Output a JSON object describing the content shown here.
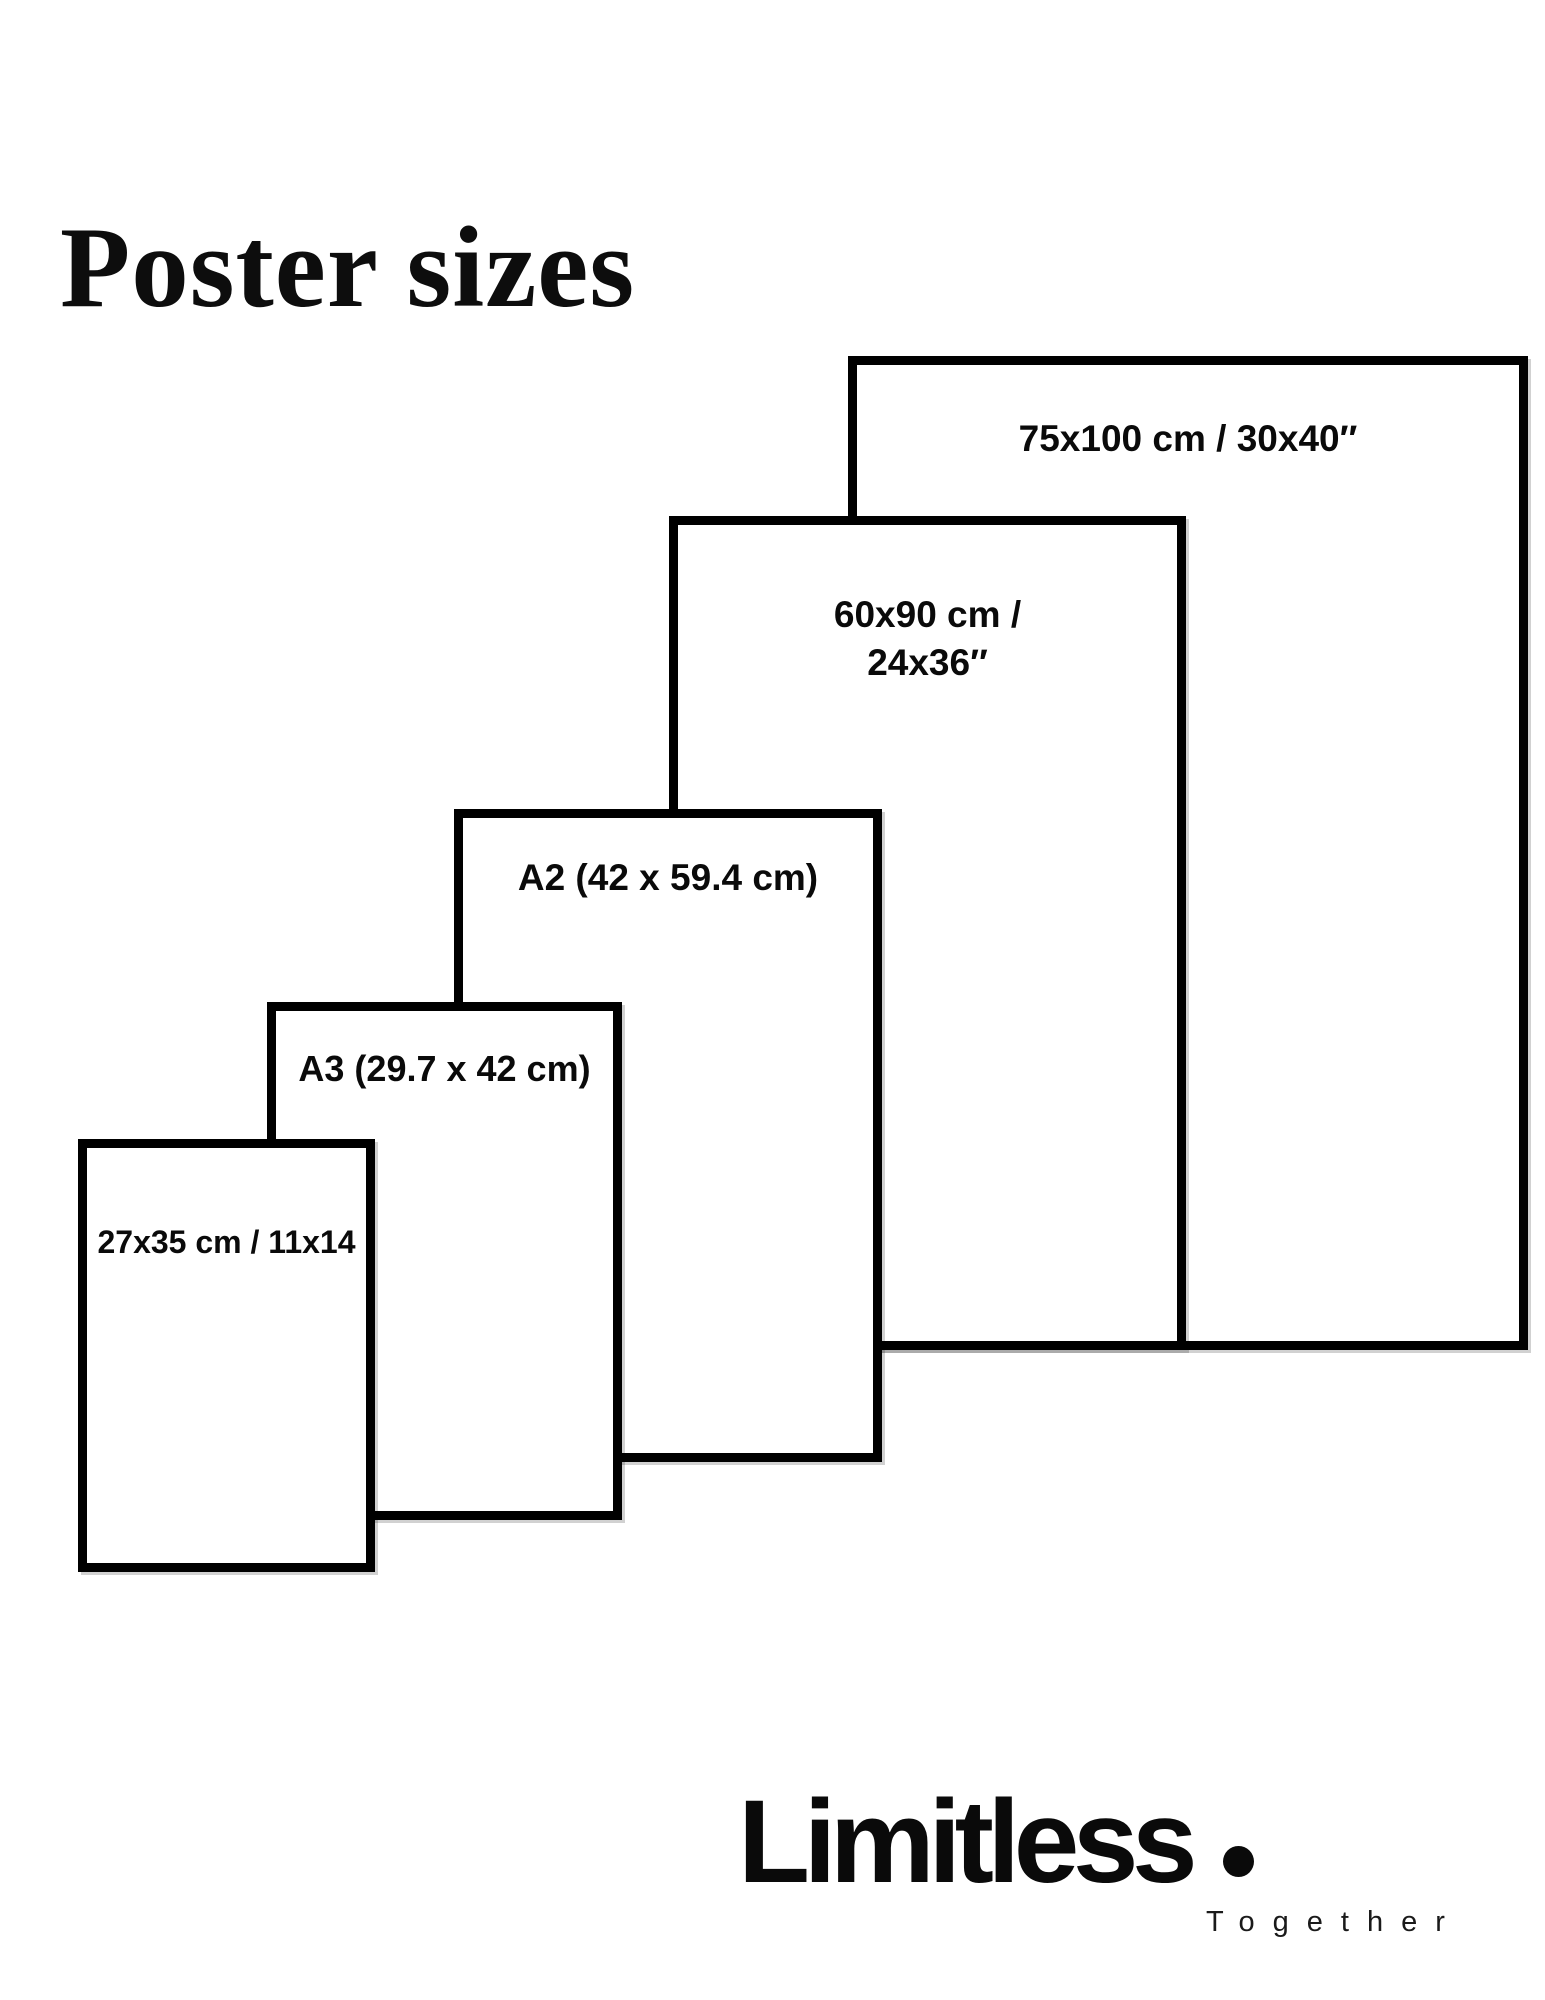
{
  "page": {
    "title": "Poster sizes",
    "background_color": "#ffffff"
  },
  "diagram": {
    "name": "poster-size-comparison",
    "stroke_color": "#000000",
    "fill_color": "#ffffff",
    "sizes": [
      {
        "id": "75x100",
        "label": "75x100 cm / 30x40″"
      },
      {
        "id": "60x90",
        "label_line1": "60x90 cm /",
        "label_line2": "24x36″"
      },
      {
        "id": "a2",
        "label": "A2 (42 x 59.4 cm)"
      },
      {
        "id": "a3",
        "label": "A3 (29.7 x 42 cm)"
      },
      {
        "id": "27x35",
        "label": "27x35 cm / 11x14"
      }
    ]
  },
  "brand": {
    "wordmark": "Limitless",
    "dot_icon": "filled-circle",
    "tagline": "Together"
  }
}
